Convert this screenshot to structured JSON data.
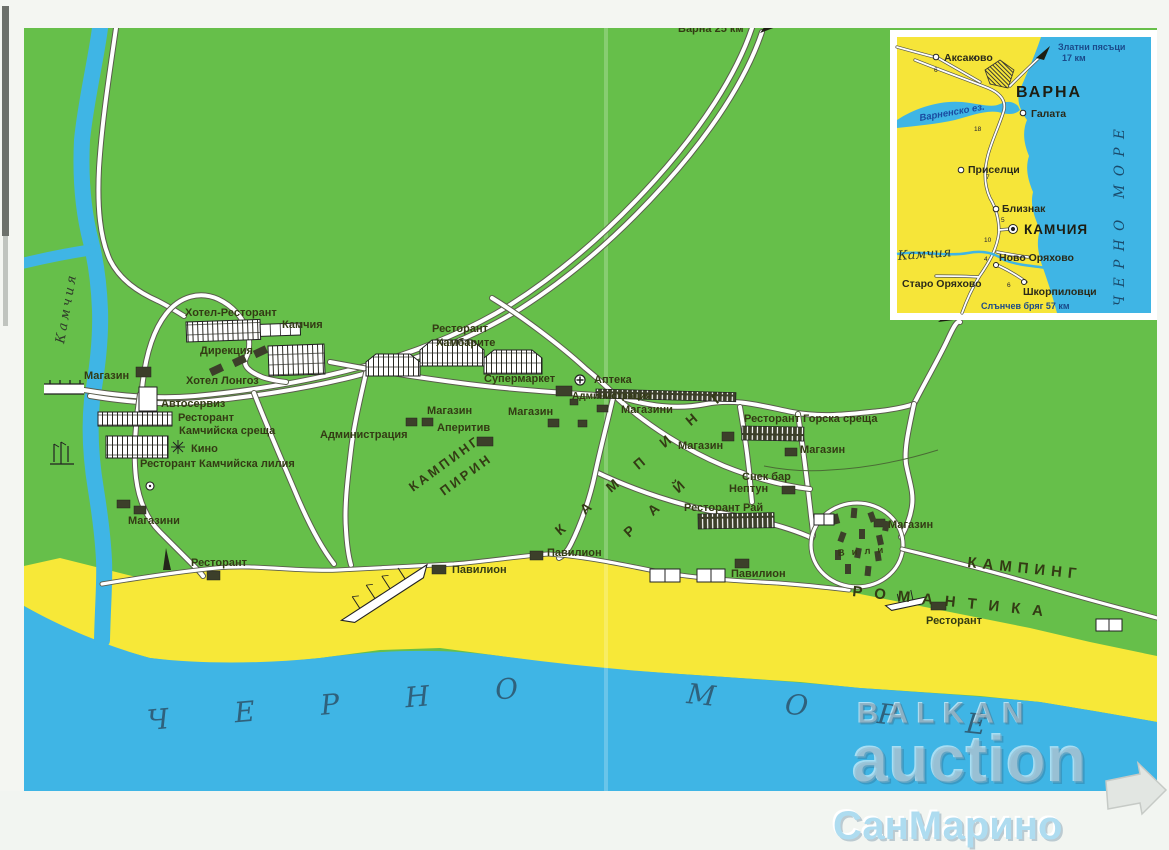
{
  "signs": {
    "varna_direction": "Варна 25 км"
  },
  "labels": {
    "hotel_restorant": "Хотел-Ресторант",
    "kamchia": "Камчия",
    "direkcia": "Дирекция",
    "magazin": "Магазин",
    "magazini": "Магазини",
    "hotel_longoz": "Хотел Лонгоз",
    "avtoserviz": "Автосервиз",
    "restorant": "Ресторант",
    "kamchiyska_sreshta": "Камчийска среща",
    "kino": "Кино",
    "restorant_kamchiyska_lilia": "Ресторант Камчийска лилия",
    "administracia": "Администрация",
    "hambarite": "Хамбарите",
    "supermarket": "Супермаркет",
    "apteka": "Аптека",
    "aperitiv": "Аперитив",
    "restorant_gorska_sreshta": "Ресторант Горска среща",
    "snek_bar": "Снек бар",
    "neptun": "Нептун",
    "restorant_rai": "Ресторант Рай",
    "pavilion": "Павилион",
    "vili": "Вили",
    "kamping": "КАМПИНГ",
    "pirin": "ПИРИН",
    "rai": "РАЙ",
    "romantika": "РОМАНТИКА"
  },
  "sea": {
    "cherno": "ЧЕРНО",
    "more": "МОРЕ"
  },
  "river_label": "Камчия",
  "inset": {
    "aksakovo": "Аксаково",
    "zlatni_line1": "Златни пясъци",
    "zlatni_line2": "17 км",
    "varna": "ВАРНА",
    "galata": "Галата",
    "varnensko_ez": "Варненско ез.",
    "priselci": "Приселци",
    "bliznak": "Близнак",
    "kamchia_town": "КАМЧИЯ",
    "kamchia_river": "Камчия",
    "novo_oryahovo": "Ново Оряхово",
    "staro_oryahovo": "Старо Оряхово",
    "shkorpilovci": "Шкорпиловци",
    "slanchev": "Слънчев бряг 57 км",
    "cherno_more": "ЧЕРНО МОРЕ",
    "road_numbers": [
      "6",
      "4",
      "18",
      "7",
      "5",
      "10",
      "4",
      "6"
    ]
  },
  "watermarks": {
    "balkan": "BALKAN",
    "auction": "auction",
    "sanmarino": "СанМарино"
  },
  "colors": {
    "land_green": "#66bf4a",
    "sand_yellow": "#f7e838",
    "sea_blue": "#3fb5e5",
    "road_white": "#ffffff",
    "building_dark": "#3c3f2a",
    "label_dark": "#333b14",
    "sea_text": "#2f617c",
    "watermark_blue": "#aedcf0"
  }
}
